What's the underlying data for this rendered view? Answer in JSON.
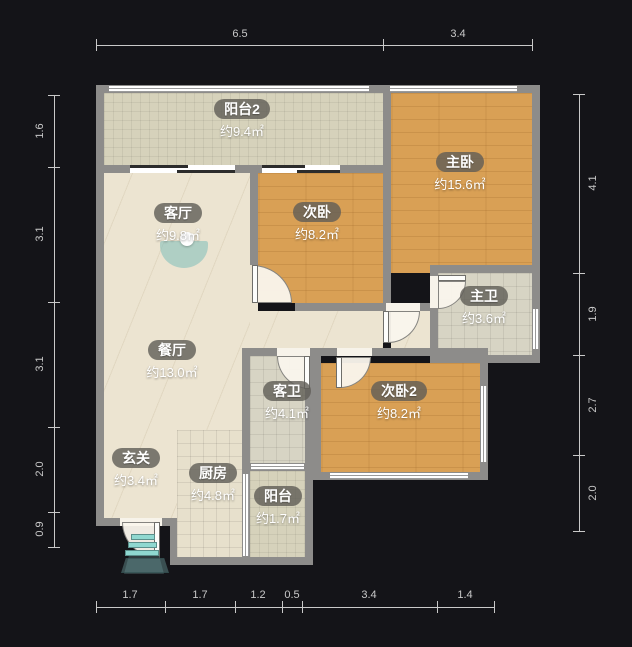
{
  "plan_title": "residential floor plan",
  "rooms": [
    {
      "id": "balcony-2",
      "name": "阳台2",
      "area": "约9.4㎡"
    },
    {
      "id": "master-bedroom",
      "name": "主卧",
      "area": "约15.6㎡"
    },
    {
      "id": "living-room",
      "name": "客厅",
      "area": "约9.8㎡"
    },
    {
      "id": "second-bedroom",
      "name": "次卧",
      "area": "约8.2㎡"
    },
    {
      "id": "master-bathroom",
      "name": "主卫",
      "area": "约3.6㎡"
    },
    {
      "id": "dining-room",
      "name": "餐厅",
      "area": "约13.0㎡"
    },
    {
      "id": "guest-bathroom",
      "name": "客卫",
      "area": "约4.1㎡"
    },
    {
      "id": "second-bedroom-2",
      "name": "次卧2",
      "area": "约8.2㎡"
    },
    {
      "id": "entry-hall",
      "name": "玄关",
      "area": "约3.4㎡"
    },
    {
      "id": "kitchen",
      "name": "厨房",
      "area": "约4.8㎡"
    },
    {
      "id": "balcony",
      "name": "阳台",
      "area": "约1.7㎡"
    }
  ],
  "dims": {
    "top": [
      "6.5",
      "3.4"
    ],
    "bottom": [
      "1.7",
      "1.7",
      "1.2",
      "0.5",
      "3.4",
      "1.4"
    ],
    "left": [
      "1.6",
      "3.1",
      "3.1",
      "2.0",
      "0.9"
    ],
    "right": [
      "4.1",
      "1.9",
      "2.7",
      "2.0"
    ]
  },
  "colors": {
    "background": "#141418",
    "wall": "#8d8c8a",
    "wood_floor": "#d9a055",
    "cream_floor": "#ece4d1",
    "green_tile": "#d6d2bb",
    "bath_tile": "#d7d4c4",
    "kitchen_tile": "#e7e0cc",
    "teal_accent": "#8fd8d0",
    "dimension_text": "#c9c9c9",
    "label_pill": "rgba(95,93,86,0.8)"
  },
  "icons": [
    "fan-icon",
    "entry-steps-icon",
    "window",
    "door-arc"
  ]
}
